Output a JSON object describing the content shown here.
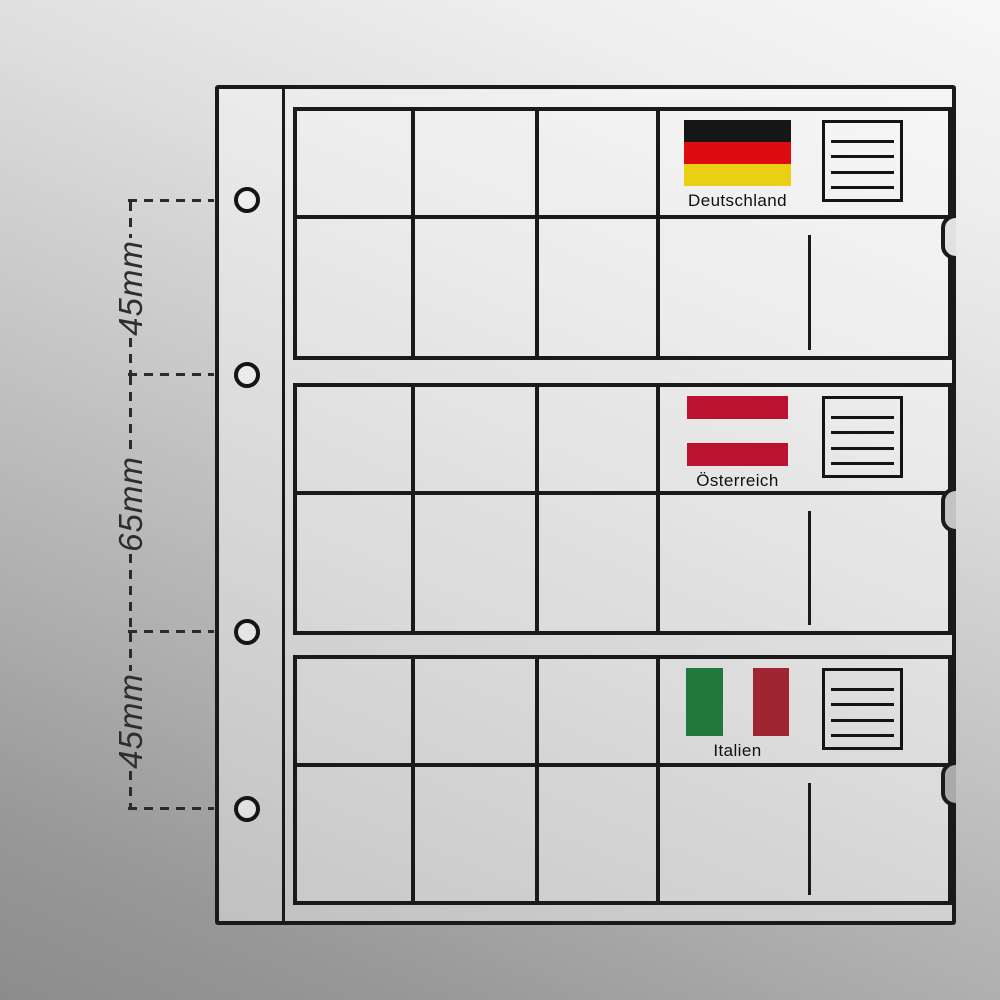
{
  "annotation": {
    "measurements": [
      {
        "text": "45mm"
      },
      {
        "text": "65mm"
      },
      {
        "text": "45mm"
      }
    ]
  },
  "sheet": {
    "line_color": "#1a1a1a",
    "hole_count": 4,
    "sections": [
      {
        "label": "Deutschland",
        "flag": {
          "name": "flag-germany",
          "stripe_direction": "horizontal",
          "stripes": [
            "#161616",
            "#dd0c10",
            "#ebcf12"
          ],
          "weights": [
            22,
            22,
            22
          ]
        },
        "card_lines": 4
      },
      {
        "label": "Österreich",
        "flag": {
          "name": "flag-austria",
          "stripe_direction": "horizontal",
          "stripes": [
            "#bb1230",
            "transparent",
            "#bb1230"
          ],
          "weights": [
            23,
            24,
            23
          ]
        },
        "card_lines": 4
      },
      {
        "label": "Italien",
        "flag": {
          "name": "flag-italy",
          "stripe_direction": "vertical",
          "stripes": [
            "#20783c",
            "transparent",
            "#9e2531"
          ],
          "weights": [
            37,
            30,
            36
          ]
        },
        "card_lines": 4
      }
    ]
  }
}
